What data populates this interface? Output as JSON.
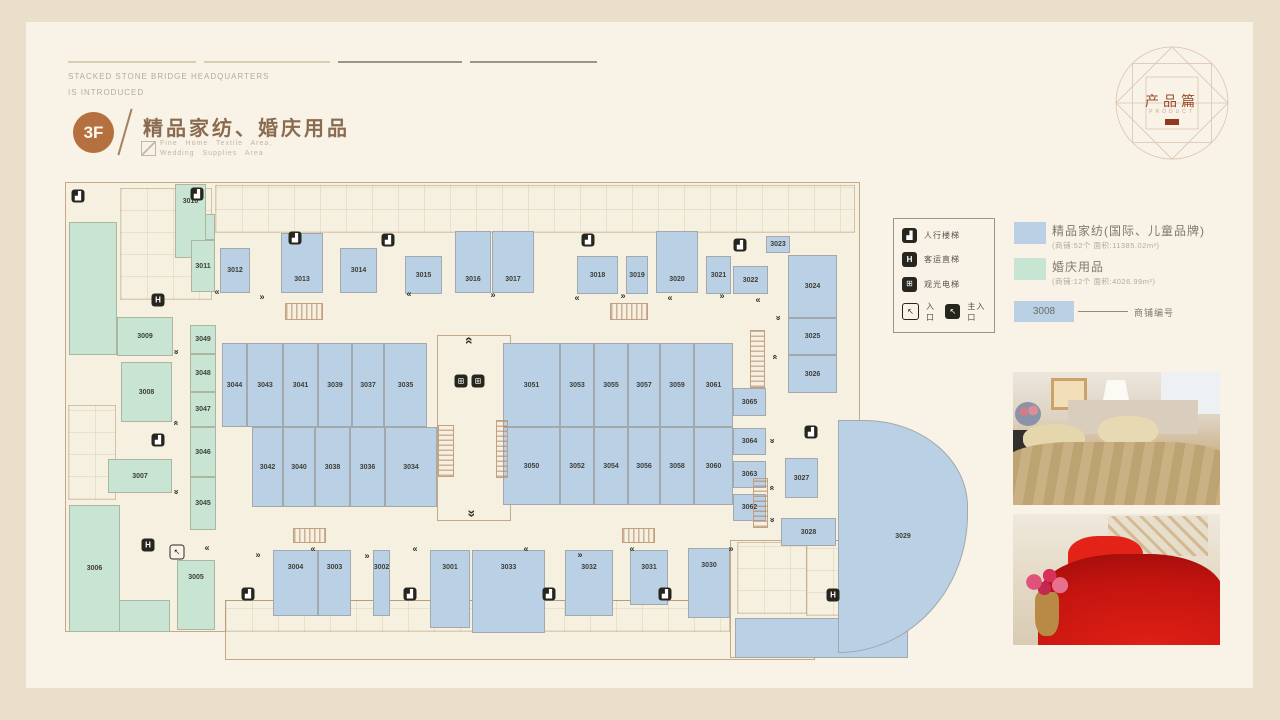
{
  "header": {
    "line1": "STACKED STONE BRIDGE HEADQUARTERS",
    "line2": "IS INTRODUCED",
    "floor": "3F",
    "title": "精品家纺、婚庆用品",
    "subtitle_line1": "Fine Home Textile Area,",
    "subtitle_line2": "Wedding Supplies Area"
  },
  "emblem": {
    "title": "产品篇",
    "subtitle": "PRODUCT"
  },
  "facility_legend": {
    "items": [
      {
        "icon": "stairs-icon",
        "label": "人行楼梯"
      },
      {
        "icon": "elevator-icon",
        "label": "客运直梯"
      },
      {
        "icon": "sightseeing-elevator-icon",
        "label": "观光电梯"
      }
    ],
    "entrance_label": "入口",
    "main_entrance_label": "主入口"
  },
  "category_legend": {
    "items": [
      {
        "name": "精品家纺(国际、儿童品牌)",
        "detail": "(商铺:52个 面积:11385.02m²)",
        "color": "#b9d0e5"
      },
      {
        "name": "婚庆用品",
        "detail": "(商铺:12个 面积:4026.99m²)",
        "color": "#c8e4d3"
      }
    ],
    "number_example": {
      "value": "3008",
      "label": "商铺编号"
    }
  },
  "plan": {
    "outlines": [
      [
        65,
        182,
        795,
        450
      ],
      [
        225,
        600,
        590,
        60
      ],
      [
        730,
        540,
        178,
        118
      ],
      [
        437,
        335,
        74,
        186
      ]
    ],
    "details": [
      [
        215,
        185,
        640,
        48
      ],
      [
        120,
        188,
        92,
        112
      ],
      [
        68,
        405,
        48,
        95
      ],
      [
        806,
        540,
        100,
        76
      ],
      [
        737,
        542,
        70,
        72
      ],
      [
        225,
        600,
        505,
        32
      ]
    ],
    "aux": [
      {
        "c": "w",
        "r": [
          69,
          222,
          48,
          133
        ]
      },
      {
        "c": "w",
        "r": [
          69,
          600,
          101,
          32
        ]
      },
      {
        "c": "w",
        "r": [
          191,
          214,
          24,
          26
        ]
      },
      {
        "c": "t",
        "r": [
          735,
          618,
          173,
          40
        ]
      }
    ],
    "shops": [
      {
        "id": "3010",
        "c": "w",
        "t": 1,
        "r": [
          175,
          184,
          31,
          74
        ]
      },
      {
        "id": "3011",
        "c": "w",
        "r": [
          191,
          240,
          24,
          52
        ]
      },
      {
        "id": "3009",
        "c": "w",
        "r": [
          117,
          317,
          56,
          39
        ]
      },
      {
        "id": "3008",
        "c": "w",
        "r": [
          121,
          362,
          51,
          60
        ]
      },
      {
        "id": "3007",
        "c": "w",
        "r": [
          108,
          459,
          64,
          34
        ]
      },
      {
        "id": "3006",
        "c": "w",
        "r": [
          69,
          505,
          51,
          127
        ]
      },
      {
        "id": "3005",
        "c": "w",
        "t": 1,
        "r": [
          177,
          560,
          38,
          70
        ]
      },
      {
        "id": "3049",
        "c": "w",
        "r": [
          190,
          325,
          26,
          29
        ]
      },
      {
        "id": "3048",
        "c": "w",
        "r": [
          190,
          354,
          26,
          38
        ]
      },
      {
        "id": "3047",
        "c": "w",
        "r": [
          190,
          392,
          26,
          35
        ]
      },
      {
        "id": "3046",
        "c": "w",
        "r": [
          190,
          427,
          26,
          50
        ]
      },
      {
        "id": "3045",
        "c": "w",
        "r": [
          190,
          477,
          26,
          53
        ]
      },
      {
        "id": "3012",
        "c": "t",
        "r": [
          220,
          248,
          30,
          45
        ]
      },
      {
        "id": "3013",
        "c": "t",
        "b": 1,
        "r": [
          281,
          233,
          42,
          60
        ]
      },
      {
        "id": "3014",
        "c": "t",
        "r": [
          340,
          248,
          37,
          45
        ]
      },
      {
        "id": "3015",
        "c": "t",
        "r": [
          405,
          256,
          37,
          38
        ]
      },
      {
        "id": "3016",
        "c": "t",
        "b": 1,
        "r": [
          455,
          231,
          36,
          62
        ]
      },
      {
        "id": "3017",
        "c": "t",
        "b": 1,
        "r": [
          492,
          231,
          42,
          62
        ]
      },
      {
        "id": "3018",
        "c": "t",
        "r": [
          577,
          256,
          41,
          38
        ]
      },
      {
        "id": "3019",
        "c": "t",
        "r": [
          626,
          256,
          22,
          38
        ]
      },
      {
        "id": "3020",
        "c": "t",
        "b": 1,
        "r": [
          656,
          231,
          42,
          62
        ]
      },
      {
        "id": "3021",
        "c": "t",
        "r": [
          706,
          256,
          25,
          38
        ]
      },
      {
        "id": "3022",
        "c": "t",
        "r": [
          733,
          266,
          35,
          28
        ]
      },
      {
        "id": "3023",
        "c": "t",
        "r": [
          766,
          236,
          24,
          17
        ]
      },
      {
        "id": "3024",
        "c": "t",
        "r": [
          788,
          255,
          49,
          63
        ]
      },
      {
        "id": "3025",
        "c": "t",
        "r": [
          788,
          318,
          49,
          37
        ]
      },
      {
        "id": "3026",
        "c": "t",
        "r": [
          788,
          355,
          49,
          38
        ]
      },
      {
        "id": "3044",
        "c": "t",
        "r": [
          222,
          343,
          25,
          84
        ]
      },
      {
        "id": "3043",
        "c": "t",
        "r": [
          247,
          343,
          36,
          84
        ]
      },
      {
        "id": "3041",
        "c": "t",
        "r": [
          283,
          343,
          35,
          84
        ]
      },
      {
        "id": "3039",
        "c": "t",
        "r": [
          318,
          343,
          34,
          84
        ]
      },
      {
        "id": "3037",
        "c": "t",
        "r": [
          352,
          343,
          32,
          84
        ]
      },
      {
        "id": "3035",
        "c": "t",
        "r": [
          384,
          343,
          43,
          84
        ]
      },
      {
        "id": "3042",
        "c": "t",
        "r": [
          252,
          427,
          31,
          80
        ]
      },
      {
        "id": "3040",
        "c": "t",
        "r": [
          283,
          427,
          32,
          80
        ]
      },
      {
        "id": "3038",
        "c": "t",
        "r": [
          315,
          427,
          35,
          80
        ]
      },
      {
        "id": "3036",
        "c": "t",
        "r": [
          350,
          427,
          35,
          80
        ]
      },
      {
        "id": "3034",
        "c": "t",
        "r": [
          385,
          427,
          52,
          80
        ]
      },
      {
        "id": "3051",
        "c": "t",
        "r": [
          503,
          343,
          57,
          84
        ]
      },
      {
        "id": "3053",
        "c": "t",
        "r": [
          560,
          343,
          34,
          84
        ]
      },
      {
        "id": "3055",
        "c": "t",
        "r": [
          594,
          343,
          34,
          84
        ]
      },
      {
        "id": "3057",
        "c": "t",
        "r": [
          628,
          343,
          32,
          84
        ]
      },
      {
        "id": "3059",
        "c": "t",
        "r": [
          660,
          343,
          34,
          84
        ]
      },
      {
        "id": "3061",
        "c": "t",
        "r": [
          694,
          343,
          39,
          84
        ]
      },
      {
        "id": "3050",
        "c": "t",
        "r": [
          503,
          427,
          57,
          78
        ]
      },
      {
        "id": "3052",
        "c": "t",
        "r": [
          560,
          427,
          34,
          78
        ]
      },
      {
        "id": "3054",
        "c": "t",
        "r": [
          594,
          427,
          34,
          78
        ]
      },
      {
        "id": "3056",
        "c": "t",
        "r": [
          628,
          427,
          32,
          78
        ]
      },
      {
        "id": "3058",
        "c": "t",
        "r": [
          660,
          427,
          34,
          78
        ]
      },
      {
        "id": "3060",
        "c": "t",
        "r": [
          694,
          427,
          39,
          78
        ]
      },
      {
        "id": "3065",
        "c": "t",
        "r": [
          733,
          388,
          33,
          28
        ]
      },
      {
        "id": "3064",
        "c": "t",
        "r": [
          733,
          428,
          33,
          27
        ]
      },
      {
        "id": "3063",
        "c": "t",
        "r": [
          733,
          461,
          33,
          27
        ]
      },
      {
        "id": "3062",
        "c": "t",
        "r": [
          733,
          494,
          33,
          27
        ]
      },
      {
        "id": "3027",
        "c": "t",
        "r": [
          785,
          458,
          33,
          40
        ]
      },
      {
        "id": "3028",
        "c": "t",
        "r": [
          781,
          518,
          55,
          28
        ]
      },
      {
        "id": "3029",
        "c": "t",
        "cv": 1,
        "r": [
          838,
          420,
          130,
          233
        ]
      },
      {
        "id": "3030",
        "c": "t",
        "t": 1,
        "r": [
          688,
          548,
          42,
          70
        ]
      },
      {
        "id": "3031",
        "c": "t",
        "t": 1,
        "r": [
          630,
          550,
          38,
          55
        ]
      },
      {
        "id": "3032",
        "c": "t",
        "t": 1,
        "r": [
          565,
          550,
          48,
          66
        ]
      },
      {
        "id": "3033",
        "c": "t",
        "t": 1,
        "r": [
          472,
          550,
          73,
          83
        ]
      },
      {
        "id": "3001",
        "c": "t",
        "t": 1,
        "r": [
          430,
          550,
          40,
          78
        ]
      },
      {
        "id": "3002",
        "c": "t",
        "t": 1,
        "r": [
          373,
          550,
          17,
          66
        ]
      },
      {
        "id": "3003",
        "c": "t",
        "t": 1,
        "r": [
          318,
          550,
          33,
          66
        ]
      },
      {
        "id": "3004",
        "c": "t",
        "t": 1,
        "r": [
          273,
          550,
          45,
          66
        ]
      }
    ],
    "escalators": [
      {
        "o": "h",
        "r": [
          285,
          303,
          38,
          17
        ]
      },
      {
        "o": "h",
        "r": [
          610,
          303,
          38,
          17
        ]
      },
      {
        "o": "h",
        "r": [
          293,
          528,
          33,
          15
        ]
      },
      {
        "o": "h",
        "r": [
          622,
          528,
          33,
          15
        ]
      },
      {
        "o": "v",
        "r": [
          438,
          425,
          16,
          52
        ]
      },
      {
        "o": "v",
        "r": [
          496,
          420,
          12,
          58
        ]
      },
      {
        "o": "v",
        "r": [
          750,
          330,
          15,
          58
        ]
      },
      {
        "o": "v",
        "r": [
          753,
          478,
          15,
          50
        ]
      }
    ],
    "icons": [
      {
        "t": "st",
        "x": 78,
        "y": 196
      },
      {
        "t": "st",
        "x": 197,
        "y": 194
      },
      {
        "t": "st",
        "x": 295,
        "y": 238
      },
      {
        "t": "st",
        "x": 388,
        "y": 240
      },
      {
        "t": "st",
        "x": 588,
        "y": 240
      },
      {
        "t": "st",
        "x": 740,
        "y": 245
      },
      {
        "t": "st",
        "x": 811,
        "y": 432
      },
      {
        "t": "st",
        "x": 158,
        "y": 440
      },
      {
        "t": "st",
        "x": 248,
        "y": 594
      },
      {
        "t": "st",
        "x": 410,
        "y": 594
      },
      {
        "t": "st",
        "x": 549,
        "y": 594
      },
      {
        "t": "st",
        "x": 665,
        "y": 594
      },
      {
        "t": "li",
        "x": 158,
        "y": 300
      },
      {
        "t": "li",
        "x": 148,
        "y": 545
      },
      {
        "t": "li",
        "x": 833,
        "y": 595
      },
      {
        "t": "pa",
        "x": 461,
        "y": 381
      },
      {
        "t": "pa",
        "x": 478,
        "y": 381
      },
      {
        "t": "en",
        "x": 177,
        "y": 552
      }
    ],
    "arrows": [
      {
        "d": "l",
        "x": 217,
        "y": 292
      },
      {
        "d": "l",
        "x": 409,
        "y": 294
      },
      {
        "d": "l",
        "x": 577,
        "y": 298
      },
      {
        "d": "l",
        "x": 670,
        "y": 298
      },
      {
        "d": "l",
        "x": 758,
        "y": 300
      },
      {
        "d": "l",
        "x": 207,
        "y": 548
      },
      {
        "d": "l",
        "x": 313,
        "y": 549
      },
      {
        "d": "l",
        "x": 415,
        "y": 549
      },
      {
        "d": "l",
        "x": 526,
        "y": 549
      },
      {
        "d": "l",
        "x": 632,
        "y": 549
      },
      {
        "d": "r",
        "x": 262,
        "y": 297
      },
      {
        "d": "r",
        "x": 493,
        "y": 295
      },
      {
        "d": "r",
        "x": 623,
        "y": 296
      },
      {
        "d": "r",
        "x": 722,
        "y": 296
      },
      {
        "d": "r",
        "x": 258,
        "y": 555
      },
      {
        "d": "r",
        "x": 367,
        "y": 556
      },
      {
        "d": "r",
        "x": 580,
        "y": 555
      },
      {
        "d": "r",
        "x": 731,
        "y": 549
      },
      {
        "d": "u",
        "x": 176,
        "y": 423
      },
      {
        "d": "u",
        "x": 775,
        "y": 357
      },
      {
        "d": "u",
        "x": 772,
        "y": 488
      },
      {
        "d": "dn",
        "x": 176,
        "y": 352
      },
      {
        "d": "dn",
        "x": 176,
        "y": 492
      },
      {
        "d": "dn",
        "x": 778,
        "y": 318
      },
      {
        "d": "dn",
        "x": 772,
        "y": 441
      },
      {
        "d": "dn",
        "x": 772,
        "y": 520
      },
      {
        "d": "uu",
        "x": 470,
        "y": 340
      },
      {
        "d": "dd",
        "x": 470,
        "y": 514
      }
    ]
  }
}
